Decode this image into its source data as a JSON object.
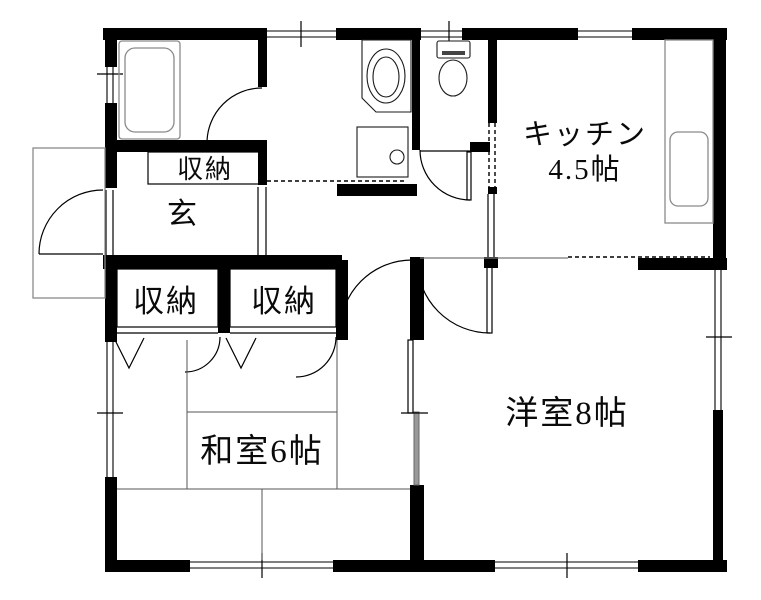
{
  "floor_plan": {
    "title": "apartment-floor-plan",
    "rooms": {
      "kitchen": {
        "label": "キッチン",
        "size": "4.5帖"
      },
      "western_room": {
        "label": "洋室8帖"
      },
      "japanese_room": {
        "label": "和室6帖"
      },
      "entrance": {
        "label": "玄"
      },
      "storage_hall": {
        "label": "収納"
      },
      "storage_left": {
        "label": "収納"
      },
      "storage_right": {
        "label": "収納"
      }
    },
    "colors": {
      "wall": "#000000",
      "background": "#ffffff",
      "fixture_line": "#8a8a8a",
      "tatami_line": "#555555",
      "sliding_panel_fill": "#999999"
    }
  }
}
